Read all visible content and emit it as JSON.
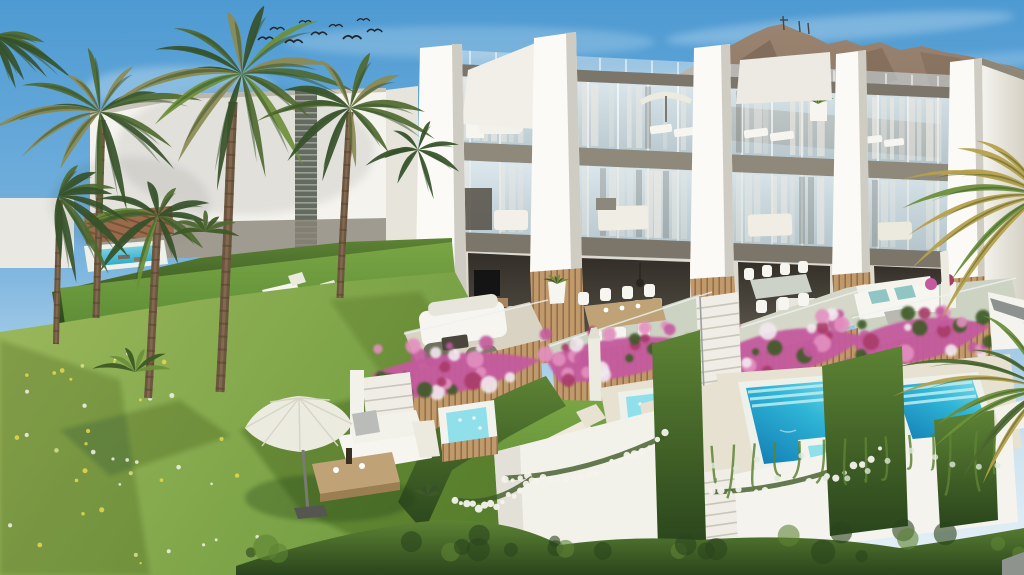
{
  "scene": {
    "type": "3d-architectural-rendering",
    "setting": "aerial view of a modern white townhouse development on a landscaped hillside",
    "time_of_day": "sunny daytime",
    "background": [
      "blue sky with wispy clouds",
      "flock of birds",
      "mountain ridge with antenna masts",
      "white neighbouring building with louvre window"
    ],
    "foreground": [
      "tropical garden with palm trees",
      "flower meadow",
      "garden parasol with outdoor sofa and coffee table"
    ],
    "inventory": {
      "townhouse_units": 4,
      "white_concrete_fins": 5,
      "stories": 3,
      "private_pools": 2,
      "plunge_hot_tubs": 3,
      "garden_pool": 1,
      "neighbour_pool": 1,
      "sun_loungers": 10,
      "open_parasols": 3,
      "closed_parasols": 2,
      "dining_sets": 2,
      "outdoor_sofas": 3,
      "birds": 9,
      "antenna_masts": 3,
      "staircases": 4
    }
  },
  "palette": {
    "sky_top": "#4d9ad2",
    "sky_mid": "#7ab4de",
    "sky_horizon": "#cfe3f0",
    "cloud_white": "#ffffff",
    "bird_dark": "#23262b",
    "mountain_lit": "#9a8470",
    "mountain_shadow": "#6d594b",
    "mountain_base": "#84705f",
    "antenna_dark": "#4a4540",
    "wall_white": "#f4f3ee",
    "wall_shaded": "#ddd9cf",
    "fin_white": "#fbfaf6",
    "fin_shade": "#cfccc3",
    "fascia_taupe": "#8f897b",
    "slab_dark": "#7c766a",
    "glass_blue": "#c6d4da",
    "glass_deep": "#9fb4bc",
    "curtain": "#eae8e1",
    "interior_dark": "#3d3830",
    "wood_slat": "#c19a6b",
    "wood_dark": "#8a6844",
    "louver_grey": "#646a60",
    "terrace_floor": "#d8d3c3",
    "terrace_green_floor": "#ccd3c3",
    "paving": "#e6e1d1",
    "lawn_bright": "#79a544",
    "lawn_mid": "#5d8c36",
    "meadow_light": "#9cb85c",
    "meadow_dark": "#6e9a3e",
    "shadow_green": "#1e3c12",
    "hedge_light": "#5d8334",
    "hedge_dark": "#2a451c",
    "flower_magenta": "#c45a9e",
    "flower_pink": "#e390c0",
    "flower_crimson": "#a83a68",
    "flower_white": "#f2e9ef",
    "leaf_green": "#3e5a26",
    "pool_shallow": "#8fe0ea",
    "pool_mid": "#2fb5d6",
    "pool_deep": "#1583b8",
    "pool_rim": "#eef0ea",
    "parasol_cream": "#ecebdf",
    "furniture_white": "#f6f5f0",
    "cushion_blue": "#8fc6c4",
    "cushion_grey": "#b9bcb9",
    "rattan_dark": "#6f6f5e",
    "trunk_brown": "#6b5640",
    "trunk_light": "#8a7154",
    "palm_deep": "#36512a",
    "palm_green": "#4f6930",
    "palm_light": "#6d8f3a",
    "palm_dry": "#8c8a52",
    "palm_gold": "#b5a04b",
    "table_wood": "#bfa377",
    "path_grey": "#8f938e"
  }
}
